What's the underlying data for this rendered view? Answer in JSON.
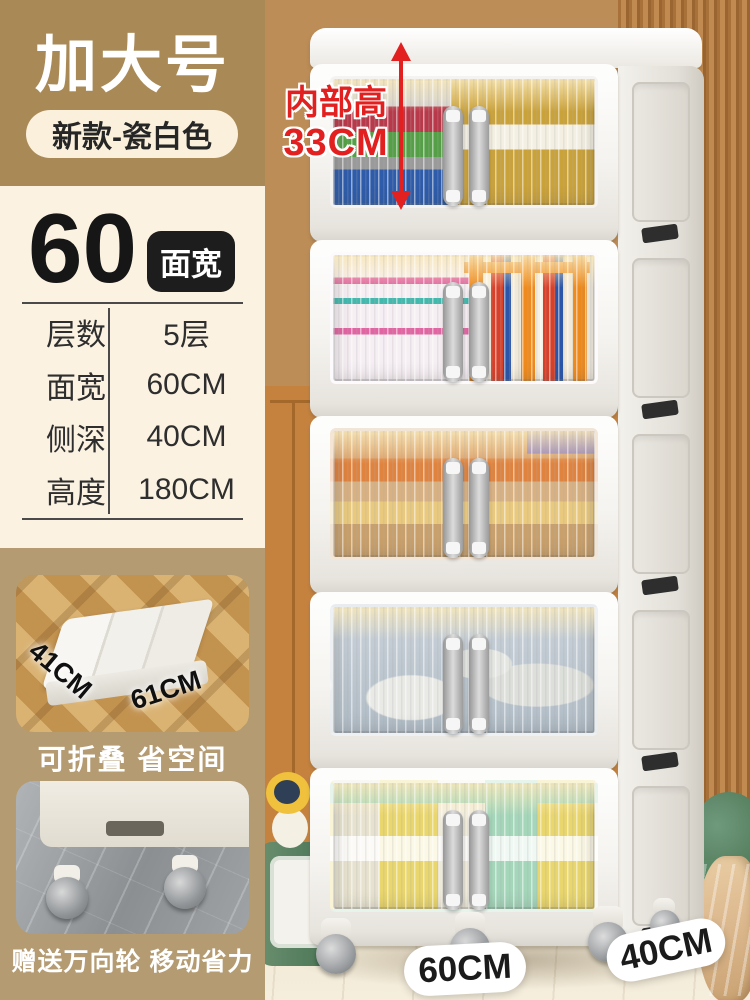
{
  "theme": {
    "header-bg": "#a98a57",
    "panel-cream": "#fbf2e2",
    "panel-tan": "#b49b72",
    "badge-cream": "#faf0dc",
    "badge-ink": "#262626",
    "ink": "#1d1d1d",
    "table-ink": "#2e2e2e",
    "red": "#e32020",
    "wall": "#bd8d57",
    "wainscot": "#c5823f",
    "wainscot-line": "#a3682a",
    "slat-a": "#c08a50",
    "slat-b": "#a8713a",
    "slat-c": "#9a6530",
    "floor": "#f0e6d0",
    "floor-edge": "#cdb68e",
    "glass-glow": "#ffeebe",
    "wheel": "#9c9fa2",
    "green": "#578060",
    "green-dark": "#43704f",
    "duck": "#efc13c",
    "duck-face": "#2f3f55",
    "blanket": "#ddb98f",
    "t1-gray": "#cfcfcf",
    "t1-red": "#b8394a",
    "t1-green": "#55a047",
    "t1-blue": "#2e5cab",
    "t1-gold": "#caa23a",
    "t2-base": "#f5eef2",
    "t2-pink": "#e265a3",
    "t2-teal": "#43b9ae",
    "t2-orange": "#ef8b1e",
    "t2-red": "#d8402a",
    "t2-blue": "#2a55a8",
    "t3-a": "#d9a069",
    "t3-b": "#e0833f",
    "t3-c": "#d8b183",
    "t3-d": "#e9c97e",
    "t3-e": "#c9a06b",
    "t3-purple": "#8d7ab5",
    "t4-a": "#c3ccd4",
    "t4-b": "#b0bcc6",
    "t4-c": "#e9eae6",
    "t5-a": "#e9d66d",
    "t5-b": "#a4d6ba",
    "t5-c": "#f2eddd"
  },
  "header": {
    "title": "加大号",
    "badge": "新款-瓷白色"
  },
  "spec": {
    "number": "60",
    "unit_badge": "面宽",
    "rows": [
      {
        "label": "层数",
        "value": "5层"
      },
      {
        "label": "面宽",
        "value": "60CM"
      },
      {
        "label": "侧深",
        "value": "40CM"
      },
      {
        "label": "高度",
        "value": "180CM"
      }
    ]
  },
  "annotation": {
    "line1": "内部高",
    "line2": "33CM"
  },
  "gallery": {
    "fold_photo": {
      "depth_label": "41CM",
      "width_label": "61CM",
      "caption": "可折叠 省空间"
    },
    "wheel_photo": {
      "caption": "赠送万向轮 移动省力"
    }
  },
  "floor_labels": {
    "front_width": "60CM",
    "side_depth": "40CM"
  }
}
